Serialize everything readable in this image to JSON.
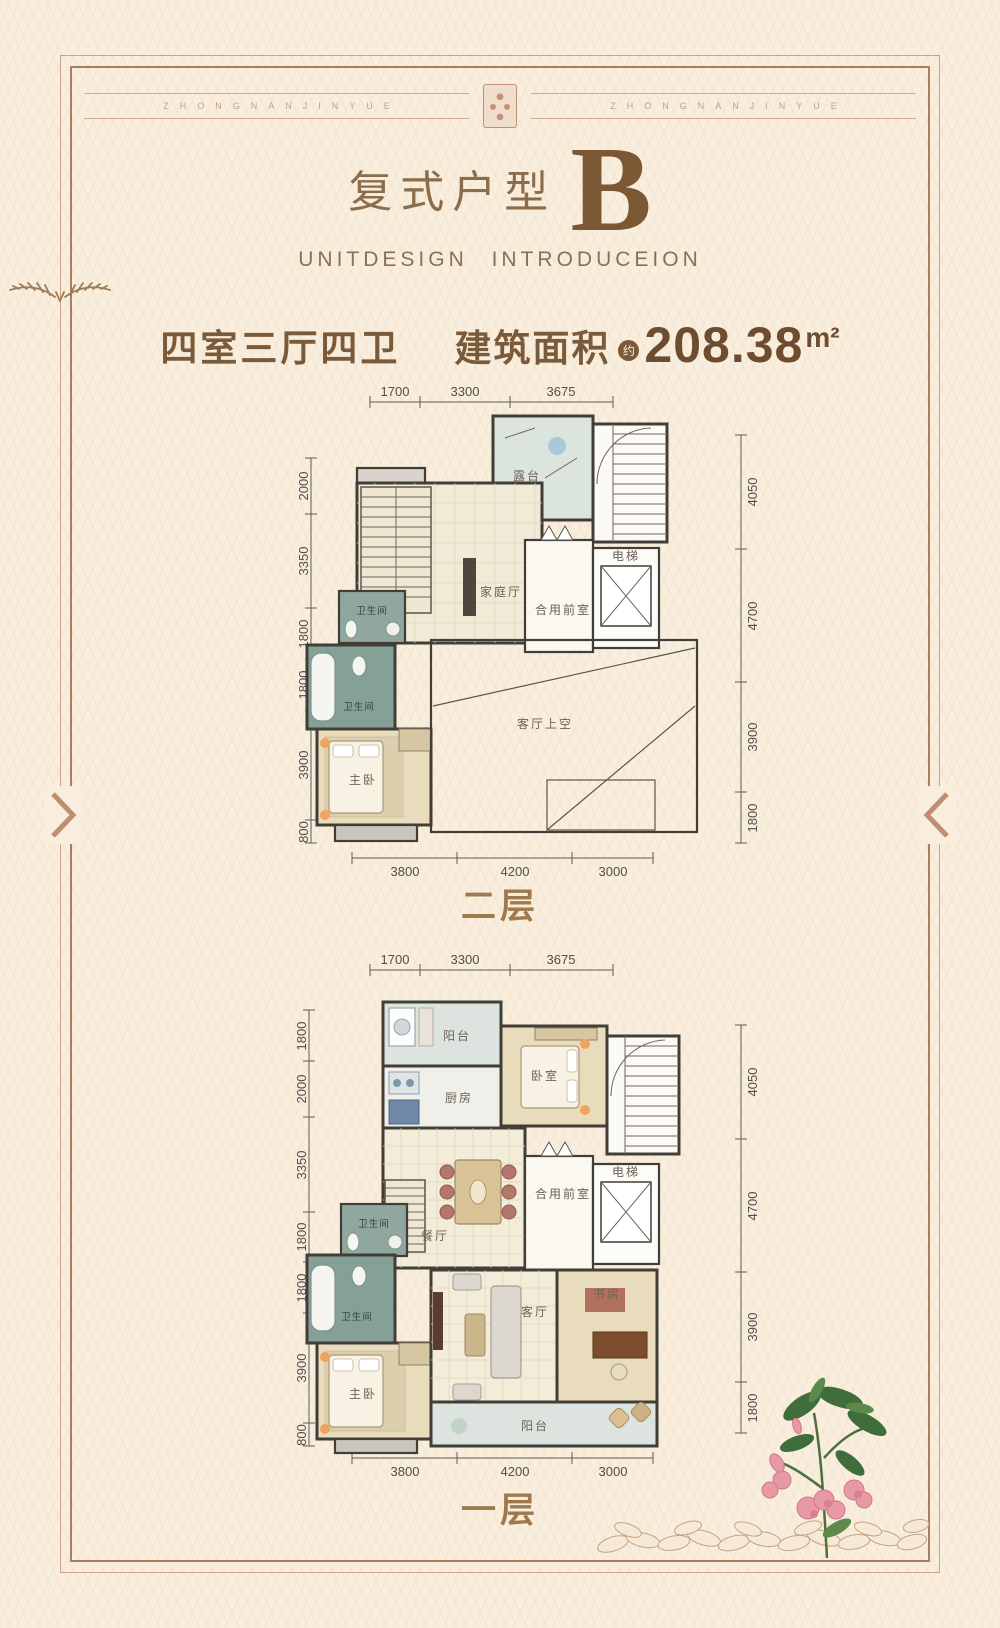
{
  "banner": {
    "left_text": "ZHONGNANJINYUE",
    "right_text": "ZHONGNANJINYUE"
  },
  "header": {
    "title_cn": "复式户型",
    "title_letter": "B",
    "subtitle": "UNITDESIGN INTRODUCEION",
    "spec_rooms": "四室三厅四卫",
    "area_label": "建筑面积",
    "area_approx": "约",
    "area_value": "208.38",
    "area_unit": "m²"
  },
  "floor2": {
    "label": "二层",
    "dims_top": [
      "1700",
      "3300",
      "3675"
    ],
    "dims_left": [
      "2000",
      "3350",
      "1800",
      "1800",
      "3900",
      "800"
    ],
    "dims_right": [
      "4050",
      "4700",
      "3900",
      "1800"
    ],
    "dims_bottom": [
      "3800",
      "4200",
      "3000"
    ],
    "rooms": {
      "terrace": "露台",
      "family_hall": "家庭厅",
      "shared_foyer": "合用前室",
      "elevator": "电梯",
      "bath_upper": "卫生间",
      "bath_lower": "卫生间",
      "master_bedroom": "主卧",
      "living_void": "客厅上空"
    }
  },
  "floor1": {
    "label": "一层",
    "dims_top": [
      "1700",
      "3300",
      "3675"
    ],
    "dims_left": [
      "1800",
      "2000",
      "3350",
      "1800",
      "1800",
      "3900",
      "800"
    ],
    "dims_right": [
      "4050",
      "4700",
      "3900",
      "1800"
    ],
    "dims_bottom": [
      "3800",
      "4200",
      "3000"
    ],
    "rooms": {
      "balcony_top": "阳台",
      "kitchen": "厨房",
      "bedroom": "卧室",
      "dining": "餐厅",
      "shared_foyer": "合用前室",
      "elevator": "电梯",
      "bath_upper": "卫生间",
      "bath_lower": "卫生间",
      "master_bedroom": "主卧",
      "living": "客厅",
      "study": "书房",
      "balcony_bottom": "阳台"
    }
  },
  "colors": {
    "background": "#f9eedd",
    "frame": "#a87e62",
    "title_brown": "#8b6c4b",
    "letter_brown": "#7b5833",
    "spec_brown": "#7b5a39",
    "value_brown": "#6d4c2f",
    "wall": "#413d37",
    "bath_teal": "#8fa79e",
    "wood": "#e9dcbd"
  }
}
